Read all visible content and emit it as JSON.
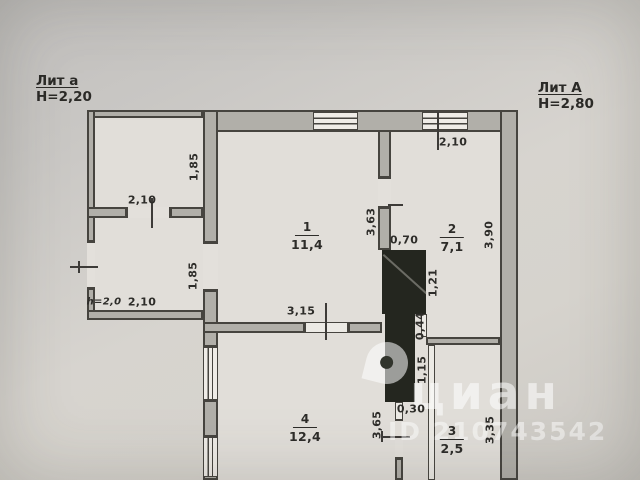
{
  "annex": {
    "title": "Лит а",
    "height": "Н=2,20",
    "upper_width": "2,10",
    "upper_depth": "1,85",
    "lower_width": "2,10",
    "lower_depth": "1,85",
    "lower_ceiling_height": "h=2,0"
  },
  "main": {
    "title": "Лит А",
    "height": "Н=2,80"
  },
  "rooms": {
    "r1": {
      "number": "1",
      "area": "11,4"
    },
    "r2": {
      "number": "2",
      "area": "7,1"
    },
    "r3": {
      "number": "3",
      "area": "2,5"
    },
    "r4": {
      "number": "4",
      "area": "12,4"
    }
  },
  "dims": {
    "room1_side": "3,63",
    "room1_bottom": "3,15",
    "chimney_width": "0,70",
    "chimney_side": "1,21",
    "stub_below_chimney": "0,44",
    "door_opening": "1,15",
    "stub_above_door": "0,30",
    "room2_width": "2,10",
    "room2_depth": "3,90",
    "room3_side": "3,35",
    "room4_side": "3,65"
  },
  "watermark": {
    "brand": "циан",
    "id": "ID 210743542"
  }
}
